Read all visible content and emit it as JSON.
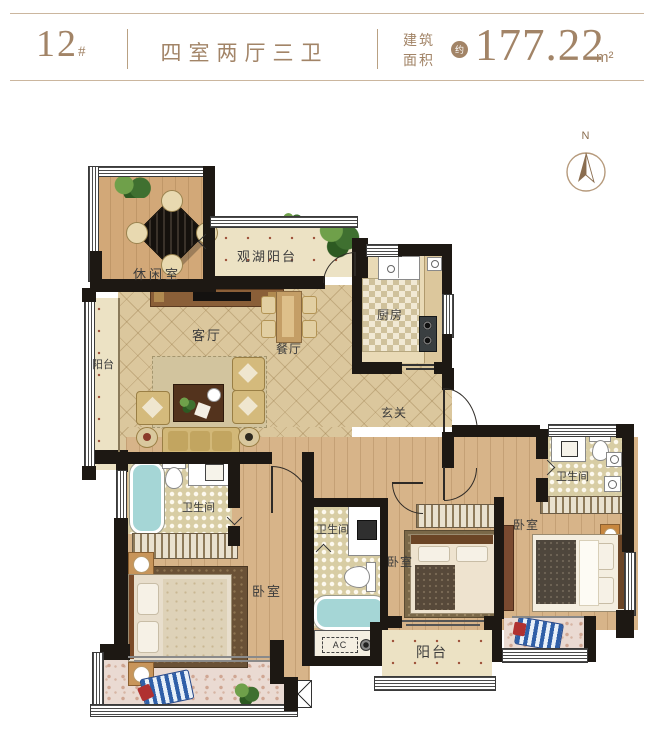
{
  "header": {
    "unit_number": "12",
    "unit_hash": "#",
    "layout": "四室两厅三卫",
    "area_label_1": "建筑",
    "area_label_2": "面积",
    "approx_badge": "约",
    "area_value": "177.22",
    "area_unit": "m²"
  },
  "compass": {
    "north": "N"
  },
  "rooms": {
    "leisure": "休闲室",
    "lake_balcony": "观湖阳台",
    "kitchen": "厨房",
    "living": "客厅",
    "dining": "餐厅",
    "balcony_left": "阳台",
    "foyer": "玄关",
    "bath_master": "卫生间",
    "bath_middle": "卫生间",
    "bath_right": "卫生间",
    "bedroom_master": "卧室",
    "bedroom_middle": "卧室",
    "bedroom_right": "卧室",
    "balcony_bottom": "阳台",
    "ac": "AC"
  },
  "colors": {
    "accent": "#a28467",
    "wall": "#1d1813",
    "wood_floor": "#d7b489",
    "tile_dot_floor": "#ece2c4",
    "bathtub": "#a5d6d6"
  }
}
